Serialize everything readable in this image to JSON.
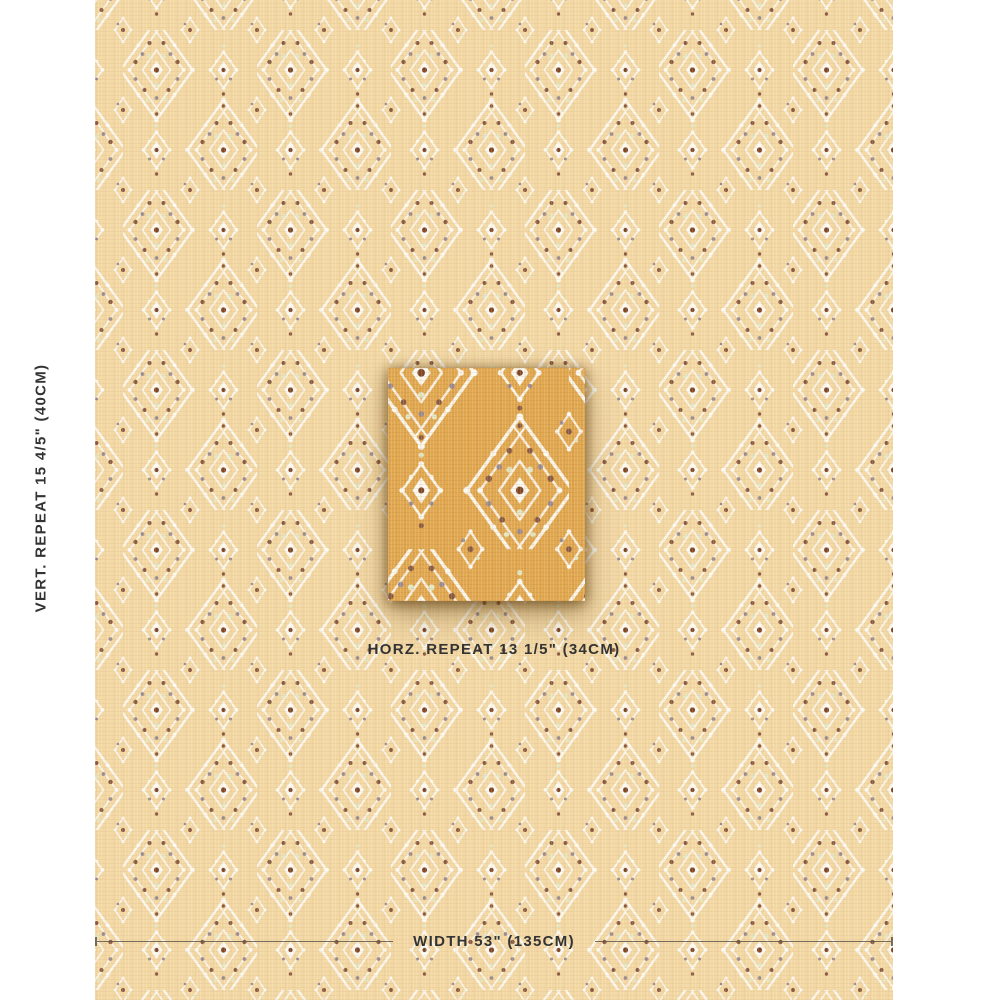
{
  "product_image": {
    "type": "fabric-swatch-product-shot",
    "labels": {
      "vertical_repeat": "VERT. REPEAT 15 4/5\" (40CM)",
      "horizontal_repeat": "HORZ. REPEAT 13 1/5\" (34CM)",
      "width": "WIDTH 53\" (135CM)"
    },
    "measurements": {
      "vertical_repeat_in": "15 4/5\"",
      "vertical_repeat_cm": "40CM",
      "horizontal_repeat_in": "13 1/5\"",
      "horizontal_repeat_cm": "34CM",
      "width_in": "53\"",
      "width_cm": "135CM"
    },
    "pattern_description": "diamond-lattice-embroidered-motif-fabric"
  },
  "colors": {
    "fabric-base": "#f3d8a4",
    "fabric-motif": "#fcf9f1",
    "dot-brown": "#8a5a41",
    "dot-mauve": "#9b8a90",
    "dot-rust": "#7d4627",
    "accent-celadon": "#e4e8c2",
    "detail-base": "#e2a850",
    "text": "#333333",
    "line": "#5f574c"
  }
}
